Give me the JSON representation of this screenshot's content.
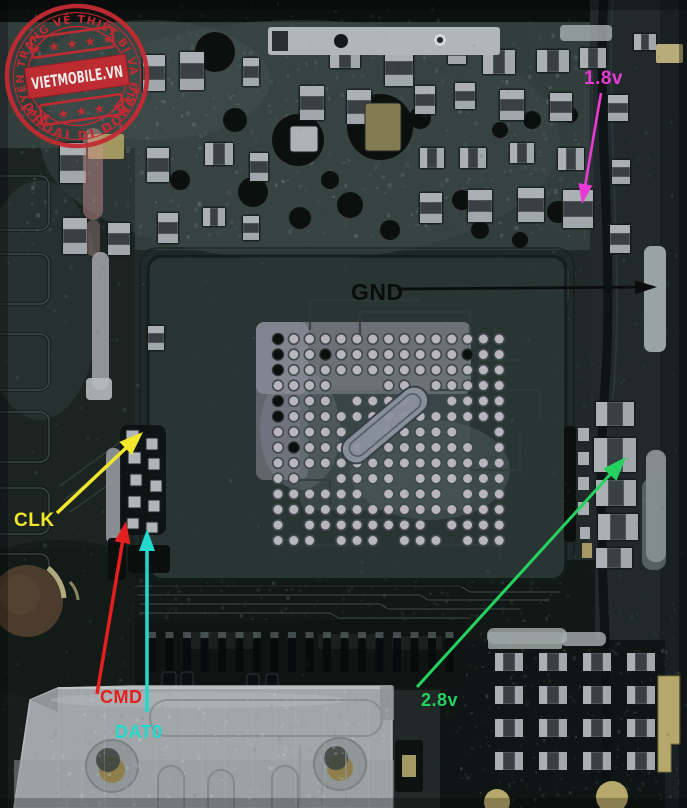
{
  "stamp": {
    "brand": "VIETMOBILE.VN",
    "arc_top": "CHUYÊN TRANG VỀ THIẾT BỊ VÀ ĐIỆN",
    "arc_bottom": "THOẠI DI ĐỘNG",
    "stars_top": "★ ★ ★ ★ ★",
    "stars_bottom": "★ ★ ★ ★ ★",
    "star": "★",
    "color": "#c32b31"
  },
  "annotations": {
    "v18": {
      "label": "1.8v",
      "color": "#ea3ad6"
    },
    "gnd": {
      "label": "GND",
      "color": "#0b0d0c"
    },
    "clk": {
      "label": "CLK",
      "color": "#f2e72a"
    },
    "cmd": {
      "label": "CMD",
      "color": "#e31f1f"
    },
    "dat0": {
      "label": "DAT0",
      "color": "#21d9cf"
    },
    "v28": {
      "label": "2.8v",
      "color": "#25d25f"
    }
  }
}
